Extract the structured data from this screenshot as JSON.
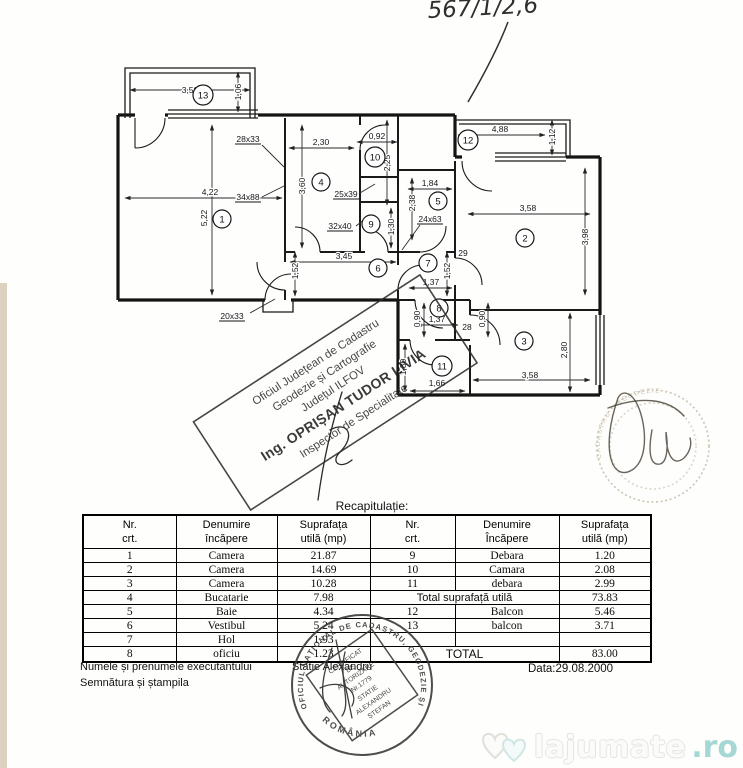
{
  "handwriting": {
    "text": "567/1/2,6"
  },
  "plan": {
    "rooms": [
      "1",
      "2",
      "3",
      "4",
      "5",
      "6",
      "7",
      "8",
      "9",
      "10",
      "11",
      "12",
      "13"
    ],
    "dims": [
      "3,50",
      "1,06",
      "28x33",
      "2,30",
      "0,92",
      "4,88",
      "1,12",
      "34x88",
      "4,22",
      "5,22",
      "3,60",
      "2,25",
      "25x39",
      "1,84",
      "2,38",
      "3,58",
      "3,98",
      "32x40",
      "1,30",
      "24x63",
      "3,45",
      "1,52",
      "1,37",
      "1,52",
      "29",
      "20x33",
      "0,90",
      "1,37",
      "28",
      "0,90",
      "1,80",
      "1,66",
      "3,58",
      "2,80"
    ]
  },
  "diagonal_stamp": {
    "line1": "Oficiul Județean de Cadastru",
    "line2": "Geodezie și Cartografie",
    "line3": "Județul ILFOV",
    "line4": "Ing. OPRIȘAN TUDOR LIVIA",
    "line5": "Inspector de Specialitate"
  },
  "round_stamp_faint": {
    "ring_text": "CADASTRU · GEODEZIE ·"
  },
  "round_stamp_bottom": {
    "ring_text": "OFICIUL NAȚIONAL DE CADASTRU, GEODEZIE ȘI CARTOGRAFIE",
    "country": "ROMÂNIA",
    "cert_line1": "CERTIFICAT",
    "cert_line2": "DE",
    "cert_line3": "AUTORIZARE",
    "cert_line4": "Nr.1779",
    "cert_line5": "STATIE",
    "cert_line6": "ALEXANDRU",
    "cert_line7": "ȘTEFAN"
  },
  "recap": {
    "title": "Recapitulație:",
    "headers_left": [
      "Nr.\ncrt.",
      "Denumire\nîncăpere",
      "Suprafața\nutilă (mp)"
    ],
    "headers_right": [
      "Nr.\ncrt.",
      "Denumire\nÎncăpere",
      "Suprafața\nutilă (mp)"
    ],
    "rows": [
      {
        "l": [
          "1",
          "Camera",
          "21.87"
        ],
        "r": [
          "9",
          "Debara",
          "1.20"
        ]
      },
      {
        "l": [
          "2",
          "Camera",
          "14.69"
        ],
        "r": [
          "10",
          "Camara",
          "2.08"
        ]
      },
      {
        "l": [
          "3",
          "Camera",
          "10.28"
        ],
        "r": [
          "11",
          "debara",
          "2.99"
        ]
      },
      {
        "l": [
          "4",
          "Bucatarie",
          "7.98"
        ],
        "r_label": "Total suprafață utilă",
        "r_value": "73.83"
      },
      {
        "l": [
          "5",
          "Baie",
          "4.34"
        ],
        "r": [
          "12",
          "Balcon",
          "5.46"
        ]
      },
      {
        "l": [
          "6",
          "Vestibul",
          "5.24"
        ],
        "r": [
          "13",
          "balcon",
          "3.71"
        ]
      },
      {
        "l": [
          "7",
          "Hol",
          "1.93"
        ],
        "r": [
          "",
          "",
          ""
        ]
      },
      {
        "l": [
          "8",
          "oficiu",
          "1.23"
        ],
        "r_label": "TOTAL",
        "r_value": "83.00"
      }
    ]
  },
  "footer": {
    "executant_label": "Numele și prenumele executantului",
    "stamp_label": "Semnătura și ștampila",
    "executant_name": "Statie Alexandru",
    "date": "Data:29.08.2000"
  },
  "watermark": {
    "name": "lajumate",
    "tld": ".ro"
  }
}
